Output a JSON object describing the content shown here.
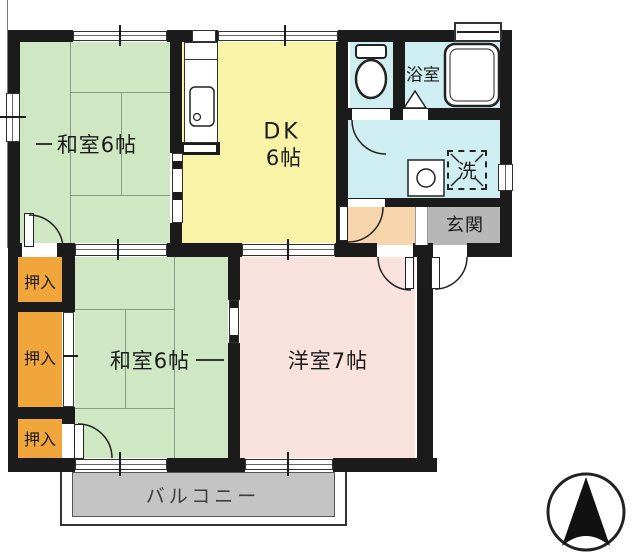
{
  "rooms": {
    "washitsu_top": "和室6帖",
    "dk_line1": "DK",
    "dk_line2": "6帖",
    "bathroom": "浴室",
    "laundry": "洗",
    "genkan": "玄関",
    "oshiire1": "押入",
    "oshiire2": "押入",
    "oshiire3": "押入",
    "washitsu_bottom": "和室6帖",
    "yoshitsu": "洋室7帖",
    "balcony": "バルコニー"
  },
  "colors": {
    "tatami_green": "#cfe8c3",
    "dk_yellow": "#f8f3a6",
    "water_cyan": "#cfeef1",
    "western_pink": "#fae2de",
    "hall_peach": "#f6d5ac",
    "closet_orange": "#f0a63a",
    "genkan_gray": "#b7b7b7",
    "balcony_gray": "#c4c4c4",
    "wall_black": "#1b1b1b"
  }
}
